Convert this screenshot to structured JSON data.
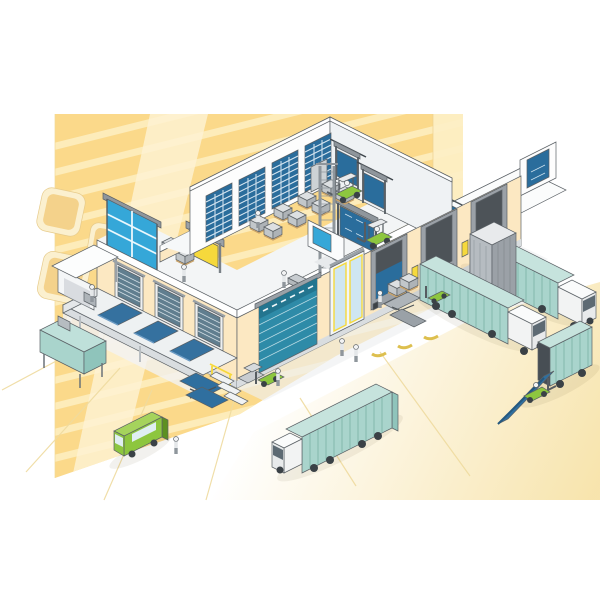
{
  "meta": {
    "title": "Isometric cutaway illustration of a two-storey logistics warehouse with loading docks, trucks and forklifts",
    "type": "illustration"
  },
  "colors": {
    "outline": "#5b6166",
    "backdrop_yellow": "#fbd98a",
    "backdrop_stripe": "#fdeec2",
    "backdrop_light": "#fef3d4",
    "backdrop_pale": "#fdf0c6",
    "tile_tan": "#f4d28b",
    "tile_border": "#fbf0cf",
    "ground_glow": "#f7e3a9",
    "ground_line": "#eeda9f",
    "wall_cream": "#fce8c2",
    "plinth_gray": "#d9dde0",
    "floor_light": "#f3f5f6",
    "door_blue": "#2a6d9c",
    "door_azure": "#35a7d8",
    "door_teal": "#2e8ba8",
    "sectional_slat": "#607e8f",
    "leveler_blue": "#35719f",
    "ramp_blue": "#2f6f9f",
    "shelter_gray": "#9ba1a7",
    "shelter_dark": "#4d5358",
    "trailer_teal": "#a9d4cc",
    "trailer_line": "#79b0a6",
    "cab_white": "#f2f3f3",
    "vehicle_green": "#8dc63f",
    "green_dark": "#5d9021",
    "accent_yellow": "#f6d93c",
    "guide_gold": "#ddbf4e",
    "metal_gray": "#aeb4b9",
    "box_gray": "#c8ccd0",
    "wheel_dark": "#3a4146"
  },
  "scene": {
    "backdrop": {
      "wall": "striped yellow wall",
      "tiles": 4,
      "glow": "soft yellow yard glow"
    },
    "building": {
      "storeys": 3,
      "ground_floor": [
        "left loading platform with 3 dock levelers",
        "3 slatted sectional doors",
        "teal overhead sectional door",
        "glazed entrance doors",
        "3 dock shelters",
        "dock scissor lift",
        "mobile stairs",
        "packing table",
        "canopy workstation",
        "tall dock house"
      ],
      "middle_floor": [
        "glazed folding door",
        "yellow high-speed roll door",
        "blue high-speed curtain door",
        "sliding door on rail",
        "goods lift tower",
        "pallet stacks",
        "forklift",
        "roof terrace",
        "end-wall sliding door"
      ],
      "top_floor": [
        "4 slatted interior doors",
        "2 high-speed curtain doors",
        "pallet rows",
        "forklift"
      ]
    },
    "vehicles": [
      "semi-truck-at-dock-2",
      "semi-truck-at-dock-3",
      "semi-truck-departing",
      "box-truck-with-yard-ramp",
      "delivery-van",
      "pallet-truck",
      "forklift-on-ramp"
    ],
    "equipment": [
      "mobile-yard-ramp",
      "dock-scissor-lift",
      "goods-lift",
      "wheel-guides x3"
    ],
    "people_count": 8
  }
}
